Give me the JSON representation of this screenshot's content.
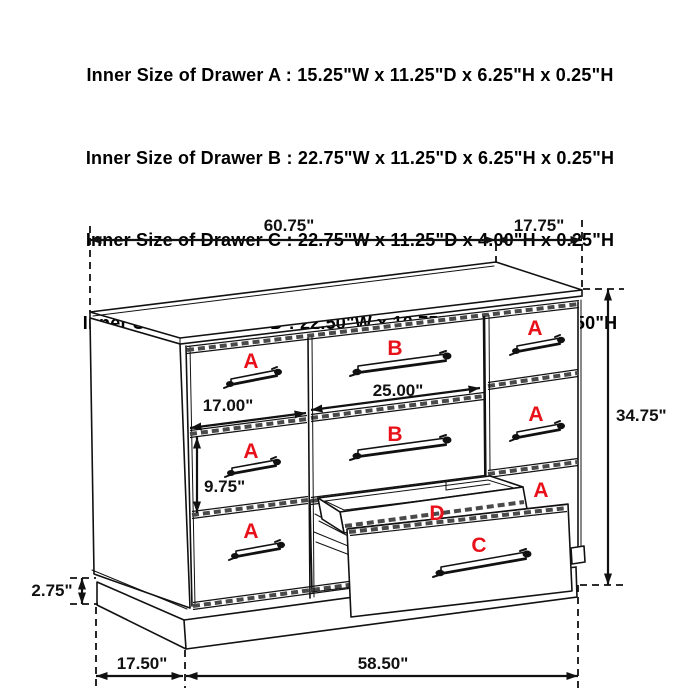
{
  "title": "Dresser drawer dimension diagram",
  "colors": {
    "label_red": "#e8111a",
    "line_black": "#111111",
    "background": "#ffffff"
  },
  "header": {
    "lines": [
      "Inner Size of Drawer A : 15.25\"W x 11.25\"D x 6.25\"H x 0.25\"H",
      "Inner Size of Drawer B : 22.75\"W x 11.25\"D x 6.25\"H x 0.25\"H",
      "Inner Size of Drawer C : 22.75\"W x 11.25\"D x 4.00\"H x 0.25\"H",
      "Inner Size of Drawer  D : 22.50\"W x 10.75\"D x 1.75\"H x 0.50\"H"
    ]
  },
  "dims": {
    "top_width": "60.75\"",
    "side_depth": "17.75\"",
    "total_height": "34.75\"",
    "left_drawer_width": "17.00\"",
    "center_drawer_width": "25.00\"",
    "left_drawer_height": "9.75\"",
    "plinth_height": "2.75\"",
    "bottom_depth": "17.50\"",
    "bottom_width": "58.50\""
  },
  "drawers": {
    "a_top_left": "A",
    "a_mid_left": "A",
    "a_bottom_left": "A",
    "b_top": "B",
    "b_mid": "B",
    "a_top_right": "A",
    "a_mid_right": "A",
    "a_third_right": "A",
    "d_open": "D",
    "c_open": "C"
  }
}
